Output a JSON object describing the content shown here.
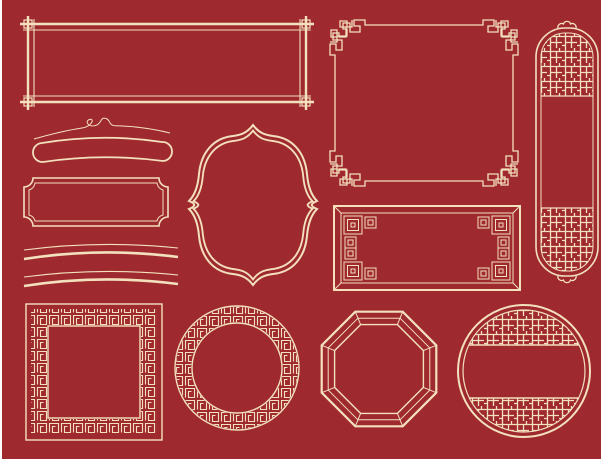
{
  "canvas": {
    "colors": {
      "background": "#9e2a30",
      "ink": "#f3e0bd",
      "margin": "#ffffff"
    }
  },
  "frames": [
    {
      "name": "double-line-banner-frame-crossed-corners"
    },
    {
      "name": "square-frame-meander-corners"
    },
    {
      "name": "vertical-scroll-banner-lattice-panels"
    },
    {
      "name": "curved-ribbon-bar-with-scroll-flourish"
    },
    {
      "name": "plaque-frame-concave-corners"
    },
    {
      "name": "quatrefoil-window-frame"
    },
    {
      "name": "double-arc-dividers"
    },
    {
      "name": "rectangle-frame-nested-square-corners"
    },
    {
      "name": "square-frame-fret-border"
    },
    {
      "name": "circle-frame-fret-border"
    },
    {
      "name": "octagon-frame-double-line"
    },
    {
      "name": "circle-frame-lattice-panels"
    }
  ]
}
